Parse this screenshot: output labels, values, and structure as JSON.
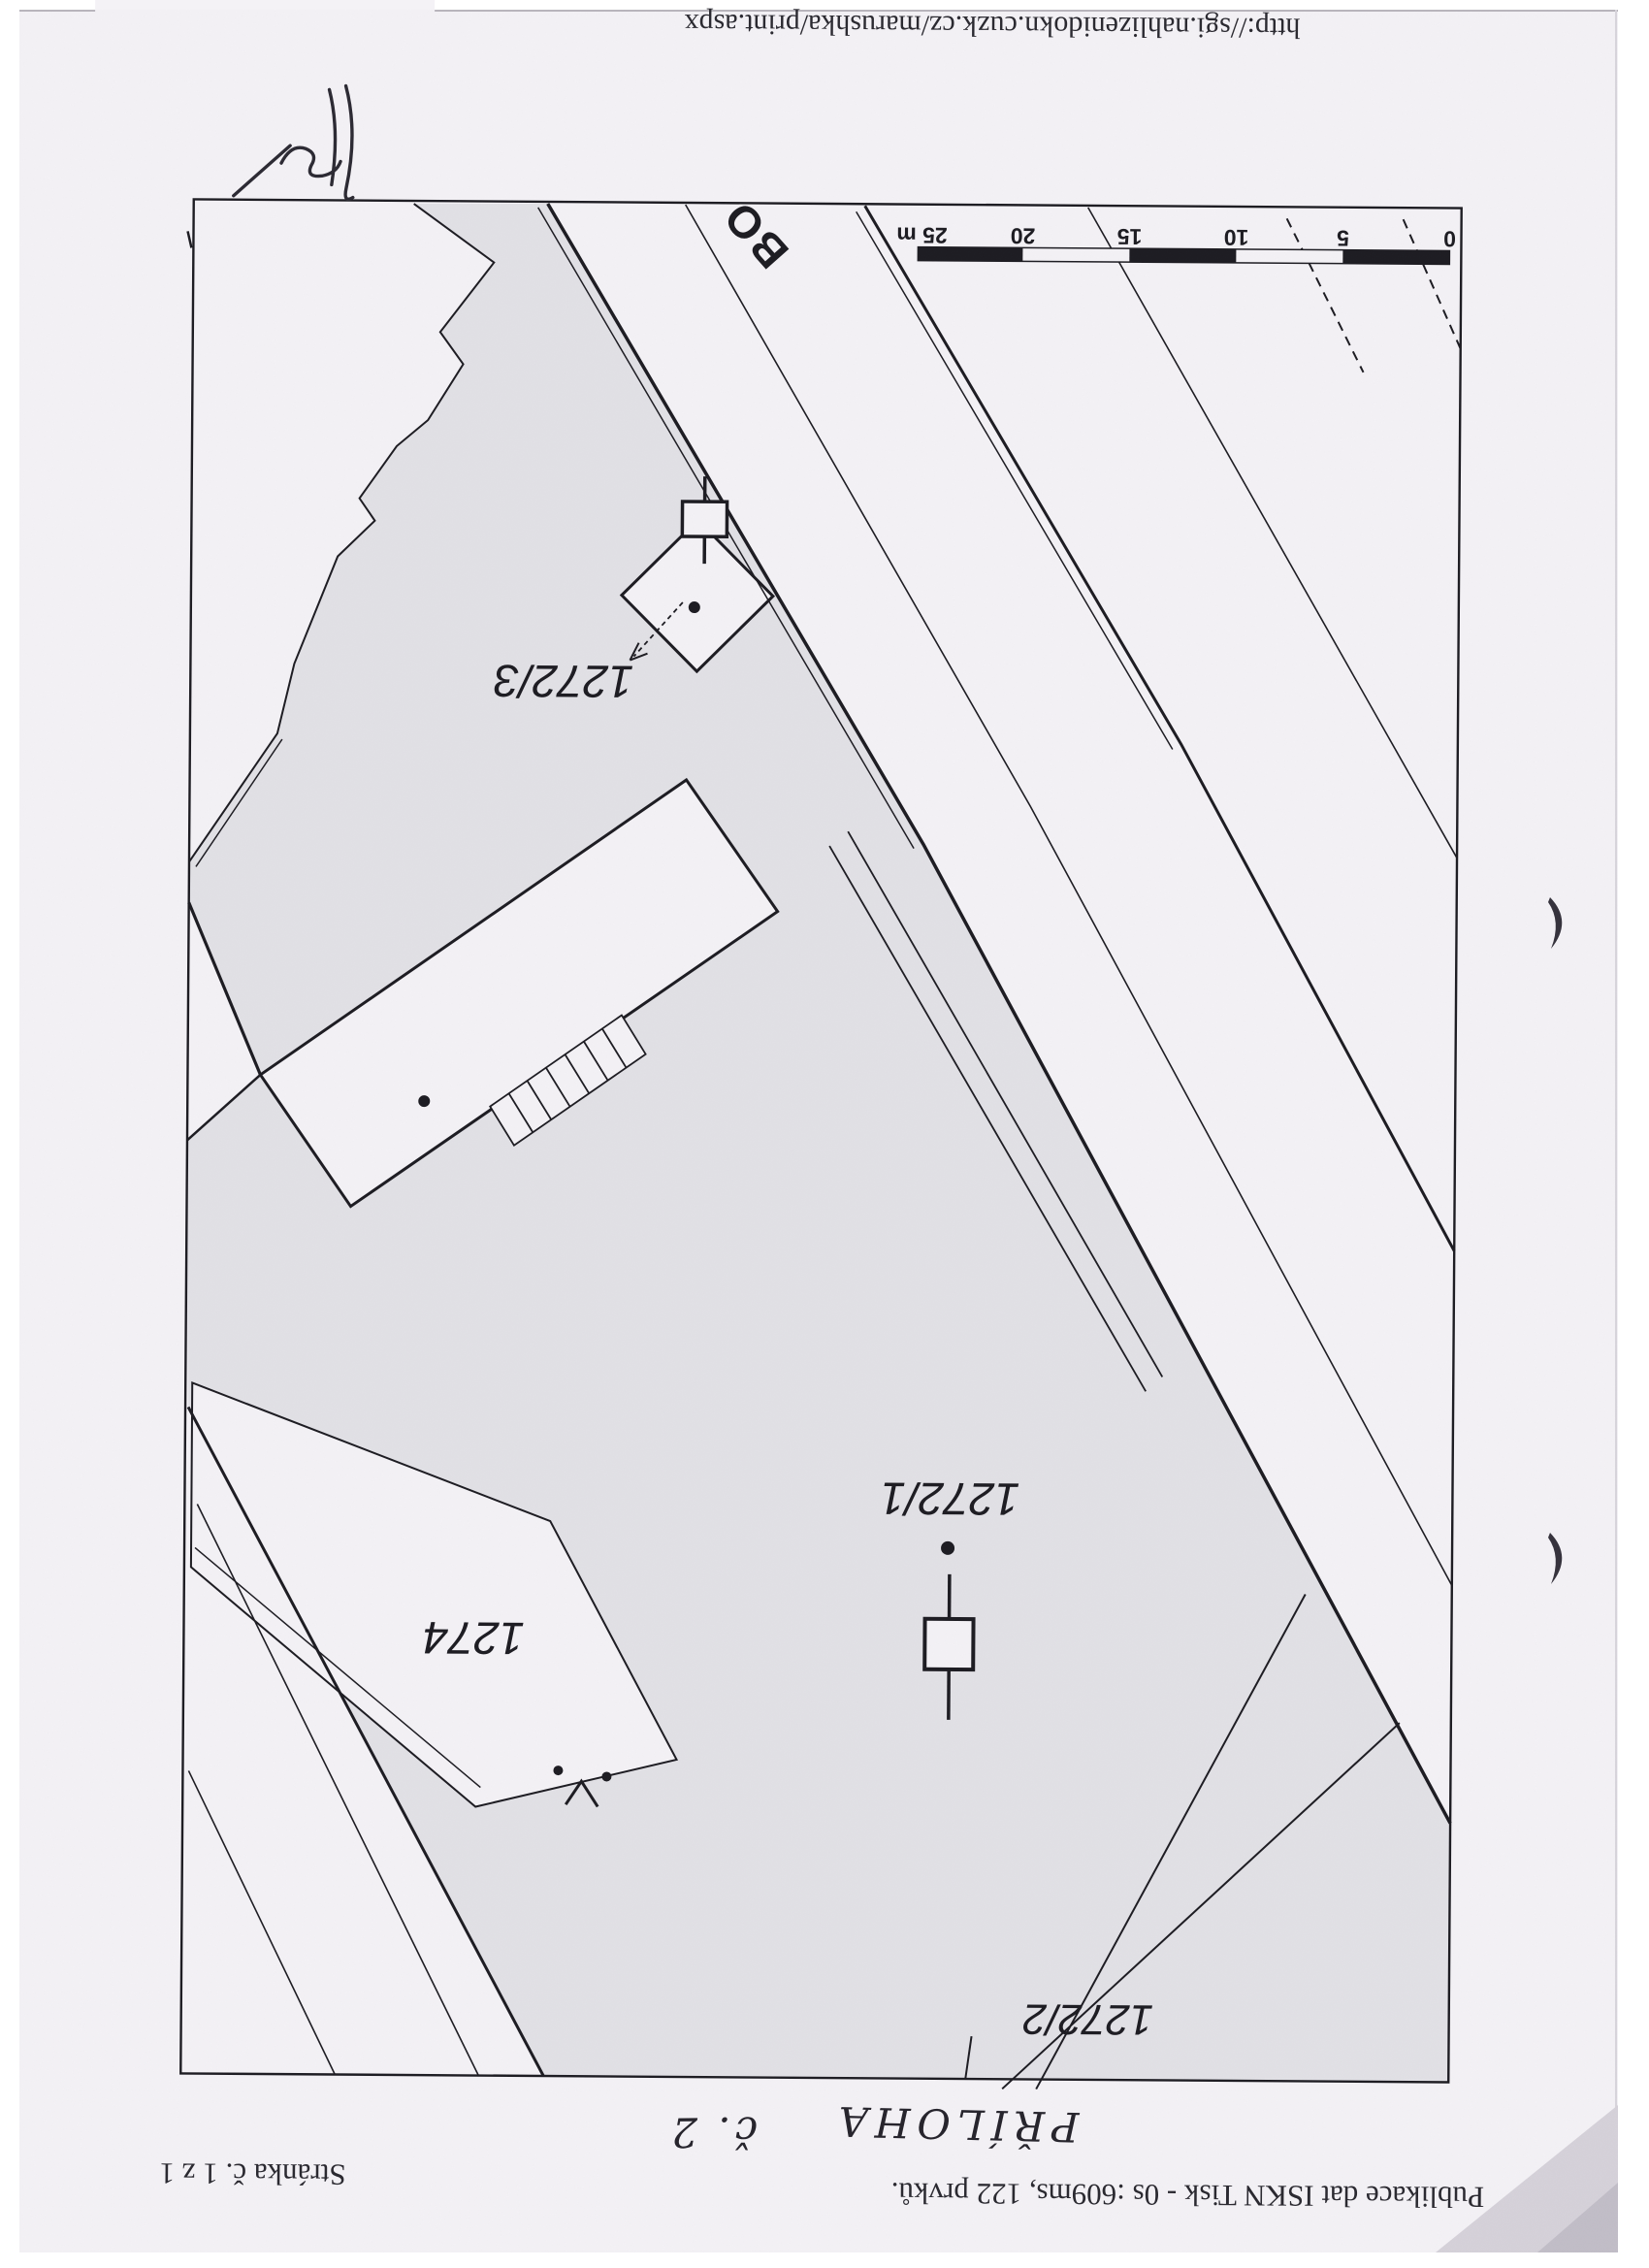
{
  "colors": {
    "paper": "#f4f2f6",
    "parcel_fill": "#e2e1e6",
    "ink": "#1d1c22",
    "corner_shadow": "#cdc9d2"
  },
  "header": {
    "url": "http://sgi.nahlizenidokn.cuzk.cz/marushka/print.aspx",
    "date": "14. 4. 2014"
  },
  "footer": {
    "publication": "Publikace dat ISKN Tisk - 0s :609ms, 122 prvků.",
    "page_number": "Stránka č. 1 z 1"
  },
  "annotations": {
    "handwritten_label": "PŘÍLOHA",
    "handwritten_number": "č. 2"
  },
  "map": {
    "street_label": "BO",
    "parcels": [
      {
        "id": "1272/3"
      },
      {
        "id": "1272/1"
      },
      {
        "id": "1274"
      },
      {
        "id": "1272/2"
      }
    ],
    "scale_bar": {
      "unit": "m",
      "ticks": [
        "25 m",
        "20",
        "15",
        "10",
        "5",
        "0"
      ]
    }
  }
}
